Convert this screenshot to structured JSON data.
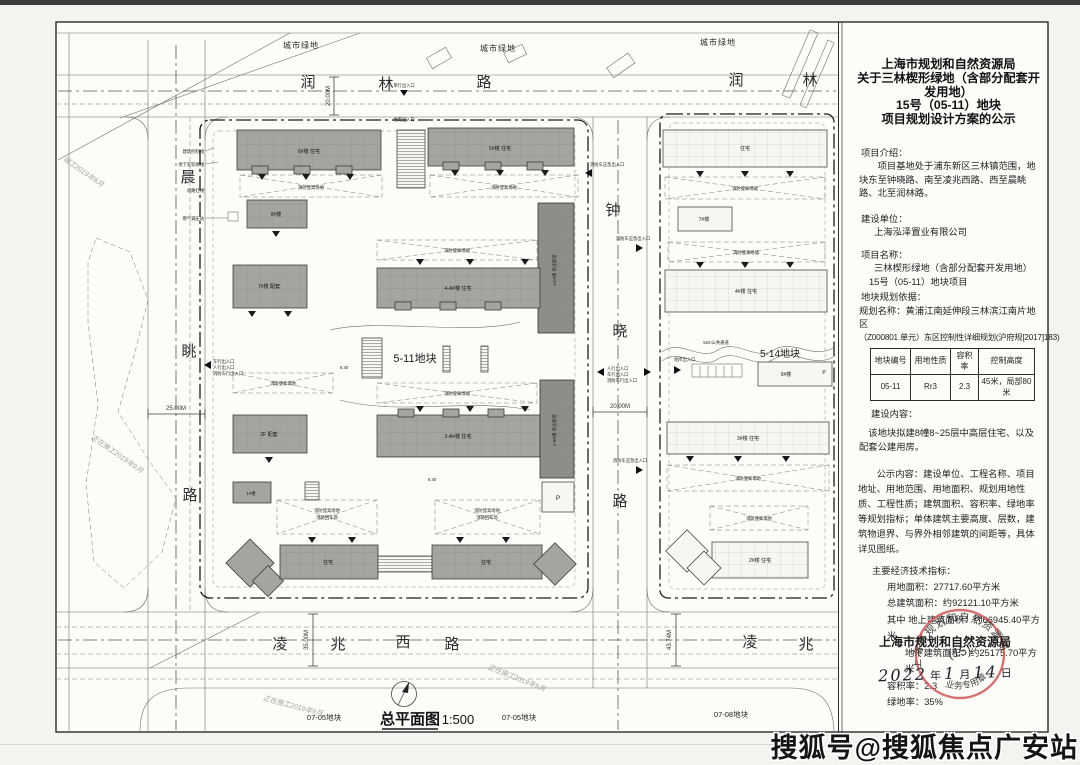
{
  "panel": {
    "title_lines": [
      "上海市规划和自然资源局",
      "关于三林楔形绿地（含部分配套开发用地）",
      "15号（05-11）地块",
      "项目规划设计方案的公示"
    ],
    "intro_label": "项目介绍：",
    "intro_text": "项目基地处于浦东新区三林镇范围，地块东至钟晓路、南至凌兆西路、西至晨眺路、北至润林路。",
    "builder_label": "建设单位：",
    "builder_name": "上海泓泽置业有限公司",
    "project_label": "项目名称：",
    "project_lines": [
      "三林楔形绿地（含部分配套开发用地）",
      "15号（05-11）地块项目"
    ],
    "basis_label": "地块规划依据：",
    "basis_line1": "规划名称：黄浦江南延伸段三林滨江南片地区",
    "basis_line2": "（Z000801 单元）东区控制性详细规划(沪府规[2017]183)",
    "table": {
      "headers": [
        "地块编号",
        "用地性质",
        "容积率",
        "控制高度"
      ],
      "row": [
        "05-11",
        "Rr3",
        "2.3",
        "45米，局部80米"
      ]
    },
    "content_label": "建设内容：",
    "content_text": "该地块拟建8幢8~25层中高层住宅、以及配套公建用房。",
    "notice_text": "公示内容：建设单位、工程名称、项目地址、用地范围、用地面积、规划用地性质、工程性质；建筑面积、容积率、绿地率等规划指标；单体建筑主要高度、层数，建筑物退界、与界外相邻建筑的间距等，具体详见图纸。",
    "indicators_label": "主要经济技术指标：",
    "indicators": [
      "用地面积：27717.60平方米",
      "总建筑面积：约92121.10平方米",
      "其中 地上建筑面积：约66945.40平方米",
      "地下建筑面积：约25175.70平方米",
      "容积率：2.3",
      "绿地率：35%"
    ],
    "agency": "上海市规划和自然资源局",
    "date": {
      "y": "2022",
      "ylabel": "年",
      "m": "1",
      "mlabel": "月",
      "d": "14",
      "dlabel": "日"
    },
    "seal": {
      "ring": "上海市规划和自然资源局",
      "center": "(15)",
      "bottom": "业务专用章",
      "color": "#cf5b5b"
    }
  },
  "map": {
    "green_label": "城市绿地",
    "roads": {
      "top": [
        "润",
        "林",
        "路",
        "润",
        "林"
      ],
      "left": [
        "晨",
        "眺",
        "路"
      ],
      "mid": [
        "钟",
        "晓",
        "路"
      ],
      "bottom": [
        "凌",
        "兆",
        "西",
        "路"
      ],
      "bottom2": [
        "凌",
        "兆"
      ]
    },
    "blocks": {
      "b511": "5-11地块",
      "b514": "5-14地块",
      "b0705": "07-05地块",
      "b0708": "07-08地块"
    },
    "passage": "52m公共通道",
    "plan_title": "总平面图",
    "plan_scale": "1:500",
    "dims": {
      "d20": "20.00M",
      "d25": "25.00M",
      "d35": "35.00M",
      "d43": "43.74M"
    },
    "fire_label": "消防登高场地",
    "fire_turn": "消防回车场",
    "buildings": {
      "b6": "6#楼 住宅",
      "b5": "5#楼 住宅",
      "b9": "9#楼",
      "b7": "7#楼 配套",
      "b4a": "4-A#楼 住宅",
      "b3a": "3-A#楼 住宅",
      "b2f": "2F 配套",
      "b1": "1#楼",
      "b4b": "4-b#楼 商业配套",
      "b2b": "2-B#楼 商业配套",
      "p": "P",
      "w_top": "住宅",
      "w7": "7#楼",
      "w4": "4#楼 住宅",
      "w9": "9#楼",
      "w3": "3#楼 住宅",
      "w2": "2#楼 住宅",
      "res": "住宅"
    },
    "entrances": {
      "ped": "人行出入口",
      "car": "车行出入口",
      "fire": "消防车行出入口",
      "garage": "地库出入口",
      "emergency": "消防车应急出入口",
      "single": "单行出入口"
    },
    "notes": {
      "ctrl": "建筑控制线",
      "base": "地下室轮廓线",
      "red": "道路红线",
      "gas": "燃气调压站"
    },
    "pencil": {
      "done": "竣工2019年9月",
      "wip": "正在施工2019年9月"
    },
    "elev": "5.40"
  },
  "watermark": "搜狐号@搜狐焦点广安站"
}
